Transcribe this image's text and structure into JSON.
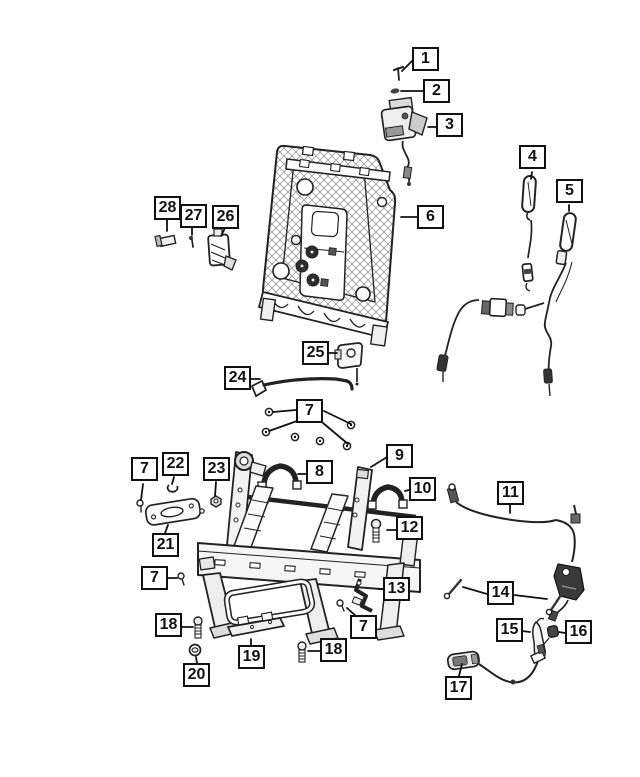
{
  "page": {
    "title": "Rear Seat Adjusters, Recliners, Frames and Shields — exploded parts diagram",
    "background": "#ffffff",
    "line_color": "#1a1a1a",
    "fill_light": "#f2f2f2",
    "fill_dark": "#3a3a3a"
  },
  "diagram": {
    "type": "exploded-parts-diagram",
    "callouts": [
      {
        "label": "1"
      },
      {
        "label": "2"
      },
      {
        "label": "3"
      },
      {
        "label": "4"
      },
      {
        "label": "5"
      },
      {
        "label": "6"
      },
      {
        "label": "28"
      },
      {
        "label": "27"
      },
      {
        "label": "26"
      },
      {
        "label": "25"
      },
      {
        "label": "24"
      },
      {
        "label": "7"
      },
      {
        "label": "22"
      },
      {
        "label": "7"
      },
      {
        "label": "23"
      },
      {
        "label": "9"
      },
      {
        "label": "8"
      },
      {
        "label": "10"
      },
      {
        "label": "11"
      },
      {
        "label": "12"
      },
      {
        "label": "21"
      },
      {
        "label": "7"
      },
      {
        "label": "13"
      },
      {
        "label": "14"
      },
      {
        "label": "18"
      },
      {
        "label": "7"
      },
      {
        "label": "15"
      },
      {
        "label": "16"
      },
      {
        "label": "18"
      },
      {
        "label": "19"
      },
      {
        "label": "20"
      },
      {
        "label": "17"
      }
    ]
  }
}
